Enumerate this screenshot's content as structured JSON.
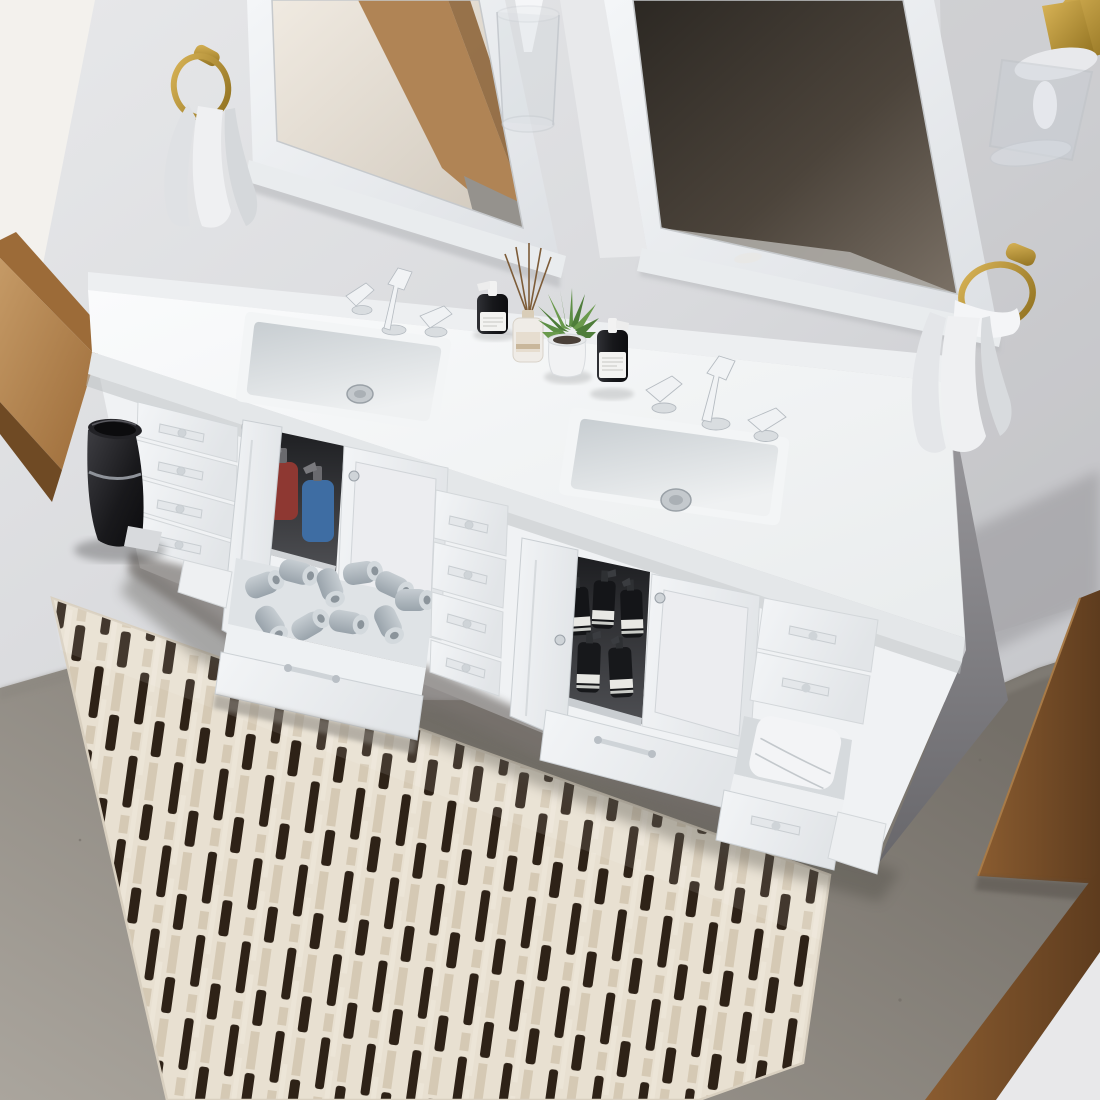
{
  "scene": {
    "type": "bathroom-interior-photo",
    "view": "overhead angled view of a white double-sink vanity",
    "objects": [
      "white double-sink vanity with shaker doors and drawers",
      "two white framed wall mirrors",
      "glass and brass wall sconces",
      "gold towel rings with hand towels",
      "oak framed window",
      "black pedal trash can",
      "open drawer full of toilet paper rolls",
      "open cabinet with red and blue pump bottles",
      "open cabinet with black pump bottles",
      "open drawer with folded towels",
      "black amber pump bottles on counter",
      "reed diffuser",
      "potted succulent",
      "striped runner rug on concrete floor",
      "wooden door at right"
    ]
  },
  "counts": {
    "mirrors": 2,
    "sinks": 2,
    "faucets": 2,
    "towel_rings": 2,
    "hand_towels": 2,
    "wall_sconces": 2,
    "toilet_paper_rolls": 10,
    "cabinet_black_bottles": 5,
    "cabinet_red_bottles": 1,
    "cabinet_blue_bottles": 1,
    "countertop_pump_bottles": 2,
    "diffuser_reeds": 5,
    "left_drawer_bank": 4,
    "center_drawer_bank": 4,
    "open_drawers": 2,
    "open_cabinet_doors": 2
  },
  "colors": {
    "wall": "#d9dadd",
    "wall_bright": "#e7e8ea",
    "wall_dark": "#c3c4c8",
    "window_light": "#f3f1ed",
    "wood_light": "#c59a66",
    "wood_mid": "#9c6b38",
    "wood_dark": "#6f4a24",
    "door_wood_light": "#8a5c30",
    "door_wood_dark": "#5e3c1e",
    "mirror_frame": "#f2f4f6",
    "glass_left_light": "#f0eae1",
    "glass_left_dark": "#d0c8bc",
    "glass_right_dark": "#2c2823",
    "glass_right_light": "#7b7166",
    "counter_light": "#fafbfc",
    "counter_dark": "#e9eced",
    "cabinet_white": "#f0f2f4",
    "cabinet_recess": "#dde1e4",
    "interior_dark": "#1c1d20",
    "interior_mid": "#4e4f53",
    "chrome": "#cfd4d8",
    "chrome_dark": "#9aa1a8",
    "brass_light": "#d9b457",
    "brass_dark": "#8f701f",
    "towel_white": "#eff0f2",
    "towel_shadow": "#d5d8db",
    "floor_light": "#aaa59d",
    "floor_dark": "#746f68",
    "rug_cream": "#e8e0d1",
    "rug_beige": "#d5c9b4",
    "rug_dark": "#2e2217",
    "tp_light": "#c6cdd2",
    "tp_dark": "#99a3ab",
    "bottle_black_light": "#303136",
    "bottle_black": "#17181b",
    "bottle_label": "#f3f3f1",
    "bottle_red": "#8e3832",
    "bottle_blue": "#3e6da3",
    "plant_green": "#4e7d3a",
    "plant_green_light": "#6a9a4c",
    "pot_white": "#f1f2f3",
    "trash_lid": "#222226",
    "sink_basin": "#c7cdd1"
  }
}
